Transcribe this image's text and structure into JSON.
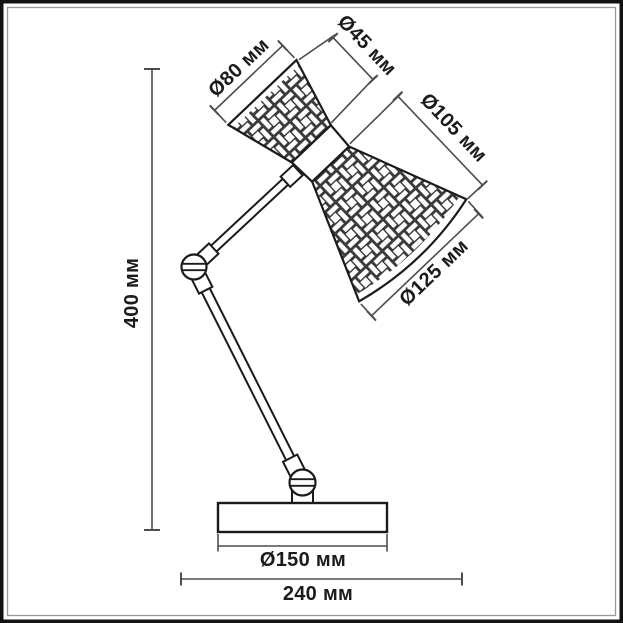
{
  "drawing": {
    "title": "table-lamp-dimension-drawing",
    "units": "мм",
    "colors": {
      "ink": "#1b1b1b",
      "dim_line": "#4d4d4d",
      "background": "#ffffff",
      "frame_outer": "#121212",
      "frame_inner": "#9a9a9a"
    },
    "dimensions": {
      "shade_top_rim": {
        "label": "Ø80 мм",
        "value": 80,
        "unit": "мм"
      },
      "shade_neck": {
        "label": "Ø45 мм",
        "value": 45,
        "unit": "мм"
      },
      "shade_mid": {
        "label": "Ø105 мм",
        "value": 105,
        "unit": "мм"
      },
      "shade_opening": {
        "label": "Ø125 мм",
        "value": 125,
        "unit": "мм"
      },
      "total_height": {
        "label": "400 мм",
        "value": 400,
        "unit": "мм"
      },
      "base_diameter": {
        "label": "Ø150 мм",
        "value": 150,
        "unit": "мм"
      },
      "total_depth": {
        "label": "240 мм",
        "value": 240,
        "unit": "мм"
      }
    }
  }
}
